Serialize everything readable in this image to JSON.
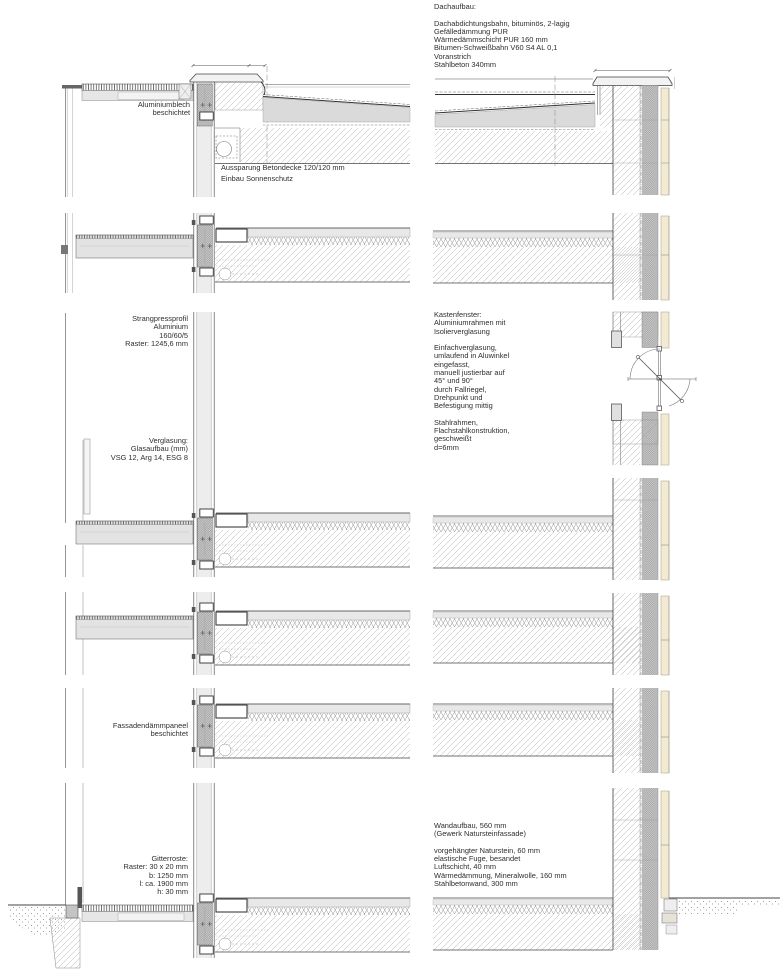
{
  "drawing_title": "Fassadenschnitt Detail",
  "annotations": {
    "dachaufbau": "Dachaufbau:\n\nDachabdichtungsbahn, bituminös, 2-lagig\nGefälledämmung PUR\nWärmedämmschicht PUR 160 mm\nBitumen-Schweißbahn V60 S4 AL 0,1\nVoranstrich\nStahlbeton 340mm",
    "aluminiumblech": "Aluminiumblech\nbeschichtet",
    "aussparung": "Aussparung Betondecke 120/120 mm\nEinbau Sonnenschutz",
    "strangpressprofil": "Strangpressprofil\nAluminium\n160/60/5\nRaster: 1245,6 mm",
    "verglasung": "Verglasung:\nGlasaufbau (mm)\nVSG 12, Arg 14, ESG 8",
    "kastenfenster": "Kastenfenster:\nAluminiumrahmen mit\nIsolierverglasung\n\nEinfachverglasung,\numlaufend in Aluwinkel\neingefasst,\nmanuell justierbar auf\n45° und 90°\ndurch Fallriegel,\nDrehpunkt und\nBefestigung mittig\n\nStahlrahmen,\nFlachstahlkonstruktion,\ngeschweißt\nd=6mm",
    "fassadenpaneel": "Fassadendämmpaneel\nbeschichtet",
    "wandaufbau": "Wandaufbau, 560 mm\n(Gewerk Natursteinfassade)\n\nvorgehängter Naturstein, 60 mm\nelastische Fuge, besandet\nLuftschicht, 40 mm\nWärmedämmung, Mineralwolle, 160 mm\nStahlbetonwand, 300 mm",
    "gitterroste": "Gitterroste:\nRaster: 30 x 20 mm\nb: 1250 mm\nl: ca. 1900 mm\nh: 30 mm"
  },
  "colors": {
    "line": "#3c3c3c",
    "hatch": "#b0b0b0",
    "stone": "#f3ead2",
    "insulation": "#d6d6d6",
    "panel": "#ededed",
    "concrete_band": "#dadada",
    "text": "#2e2e2e"
  }
}
